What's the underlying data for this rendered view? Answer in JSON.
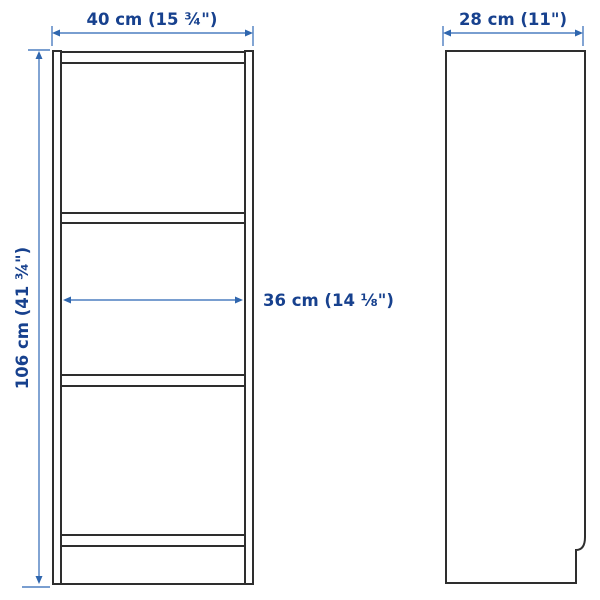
{
  "diagram": {
    "kind": "bookcase-dimension-drawing",
    "dimensions": {
      "width_label": "40 cm (15 ¾\")",
      "depth_label": "28 cm (11\")",
      "height_label": "106 cm (41 ¾\")",
      "inner_width_label": "36 cm (14 ⅛\")"
    },
    "colors": {
      "dimension_text": "#17418e",
      "dimension_line": "#4d7ec0",
      "furniture_outline": "#2e2e2e",
      "background": "#ffffff"
    }
  }
}
